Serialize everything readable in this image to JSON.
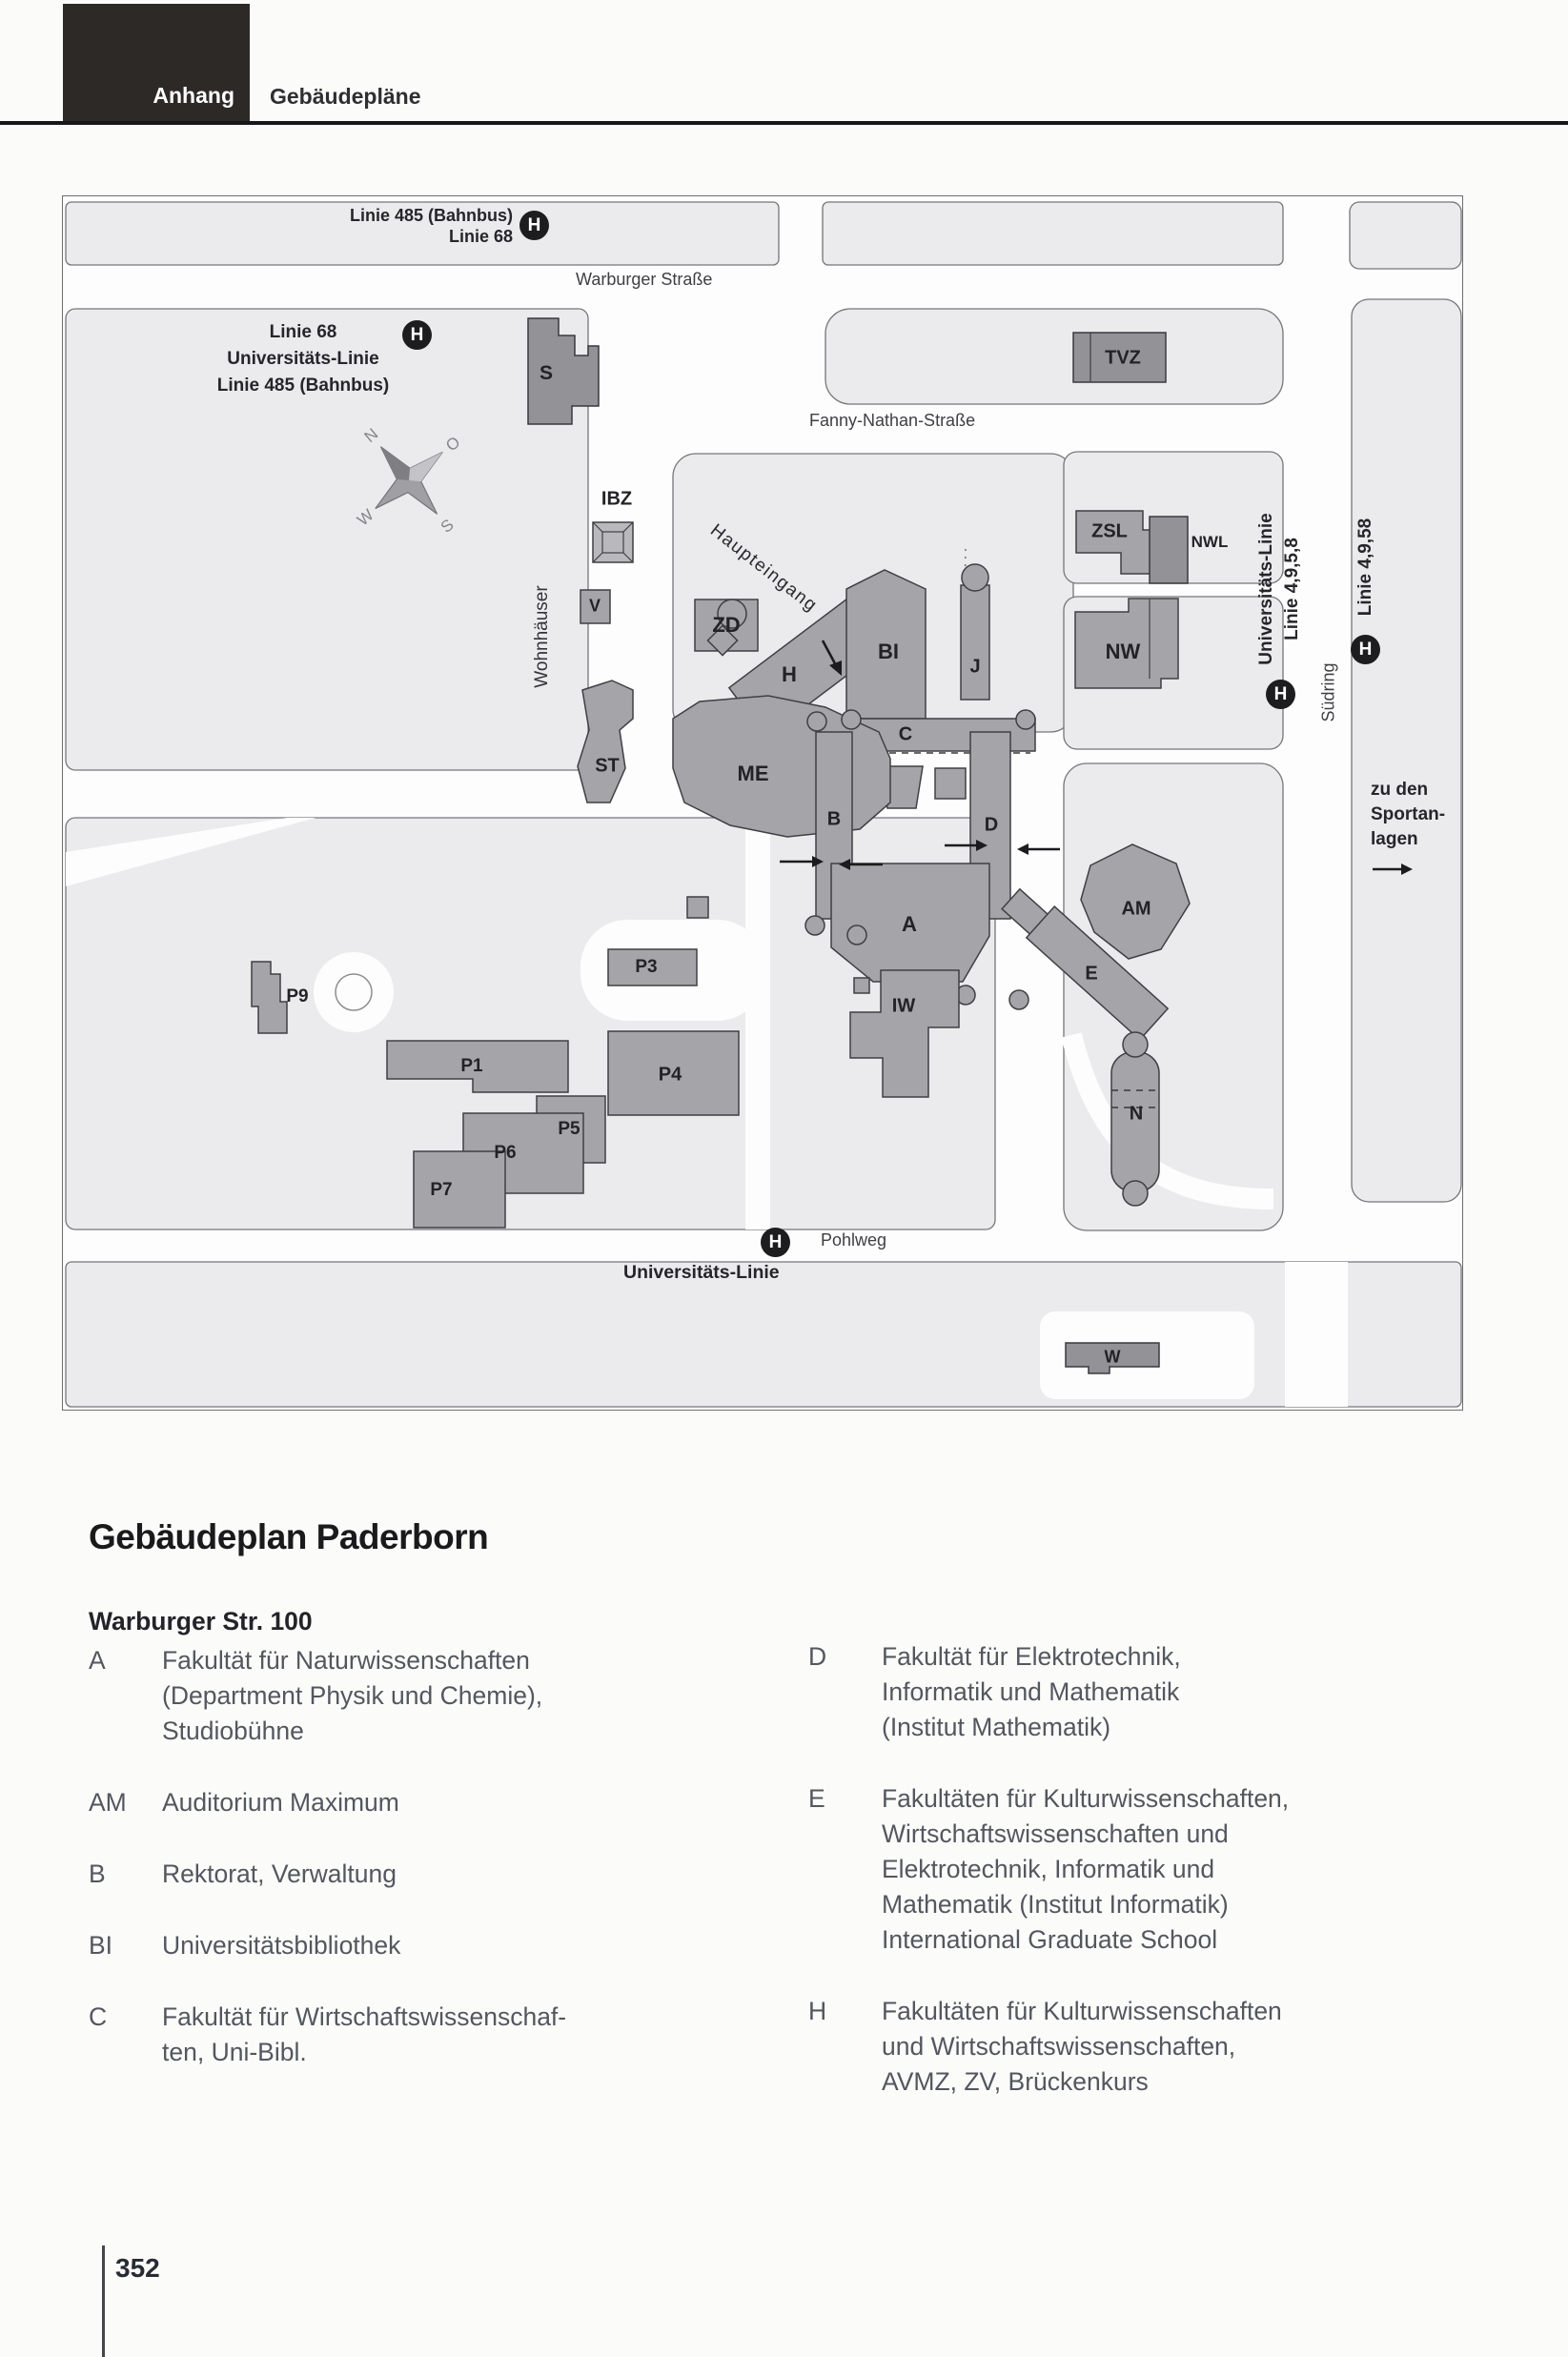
{
  "header": {
    "tab": "Anhang",
    "section": "Gebäudepläne"
  },
  "map": {
    "streets": {
      "warburger": "Warburger Straße",
      "fanny": "Fanny-Nathan-Straße",
      "pohlweg": "Pohlweg",
      "suedring": "Südring"
    },
    "transit": {
      "stop_symbol": "H",
      "top_line1": "Linie 485 (Bahnbus)",
      "top_line2": "Linie 68",
      "left_line1": "Linie 68",
      "left_line2": "Universitäts-Linie",
      "left_line3": "Linie 485 (Bahnbus)",
      "right_univ_line1": "Universitäts-Linie",
      "right_univ_line2": "Linie 4,9,5,8",
      "right_line": "Linie 4,9,58",
      "bottom_label": "Universitäts-Linie"
    },
    "annotations": {
      "wohnhaeuser": "Wohnhäuser",
      "haupteingang": "Haupteingang",
      "sport_line1": "zu den",
      "sport_line2": "Sportan-",
      "sport_line3": "lagen",
      "compass_n": "N",
      "compass_o": "O",
      "compass_s": "S",
      "compass_w": "W"
    },
    "codes": {
      "s": "S",
      "ibz": "IBZ",
      "v": "V",
      "zd": "ZD",
      "h": "H",
      "bi": "BI",
      "j": "J",
      "c": "C",
      "me": "ME",
      "st": "ST",
      "b": "B",
      "d": "D",
      "a": "A",
      "am": "AM",
      "e": "E",
      "n": "N",
      "iw": "IW",
      "tvz": "TVZ",
      "zsl": "ZSL",
      "nwl": "NWL",
      "nw": "NW",
      "w": "W",
      "p1": "P1",
      "p3": "P3",
      "p4": "P4",
      "p5": "P5",
      "p6": "P6",
      "p7": "P7",
      "p9": "P9"
    }
  },
  "legend": {
    "title": "Gebäudeplan Paderborn",
    "subtitle": "Warburger Str. 100",
    "left": [
      {
        "code": "A",
        "lines": [
          "Fakultät für Naturwissenschaften",
          "(Department Physik und Chemie),",
          "Studiobühne"
        ]
      },
      {
        "code": "AM",
        "lines": [
          "Auditorium Maximum"
        ]
      },
      {
        "code": "B",
        "lines": [
          "Rektorat, Verwaltung"
        ]
      },
      {
        "code": "BI",
        "lines": [
          "Universitätsbibliothek"
        ]
      },
      {
        "code": "C",
        "lines": [
          "Fakultät für Wirtschaftswissenschaf-",
          "ten, Uni-Bibl."
        ]
      }
    ],
    "right": [
      {
        "code": "D",
        "lines": [
          "Fakultät für Elektrotechnik,",
          "Informatik und Mathematik",
          "(Institut Mathematik)"
        ]
      },
      {
        "code": "E",
        "lines": [
          "Fakultäten für Kulturwissenschaften,",
          "Wirtschaftswissenschaften und",
          "Elektrotechnik, Informatik und",
          "Mathematik (Institut Informatik)",
          "International Graduate School"
        ]
      },
      {
        "code": "H",
        "lines": [
          "Fakultäten für Kulturwissenschaften",
          "und Wirtschaftswissenschaften,",
          "AVMZ, ZV, Brückenkurs"
        ]
      }
    ]
  },
  "footer": {
    "page_number": "352"
  }
}
